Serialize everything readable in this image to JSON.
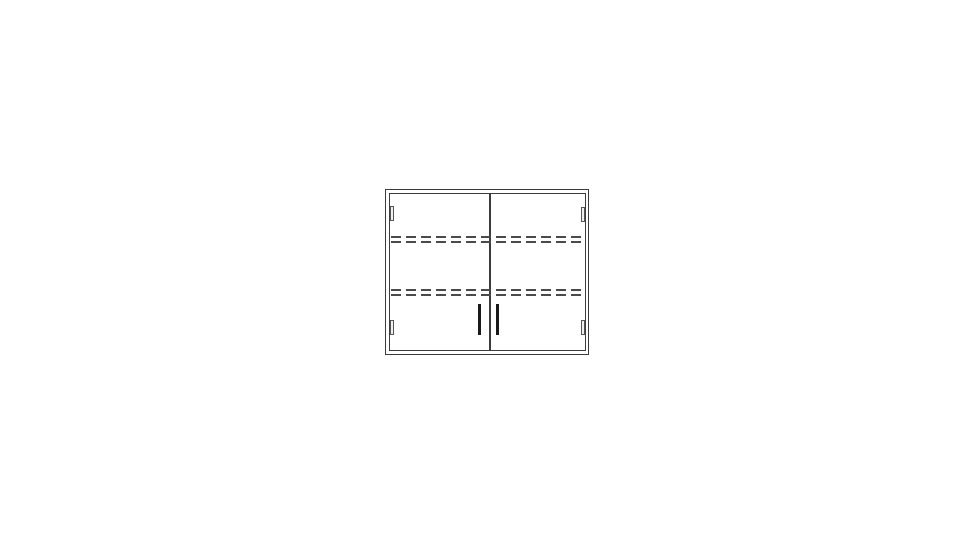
{
  "page": {
    "background_color": "#ffffff"
  },
  "drawing": {
    "title": "Double-door cabinet, front elevation line drawing",
    "type": "technical-line-drawing",
    "colors": {
      "outline": "#3c3c3c",
      "hidden_line": "#4a4a4a",
      "handle": "#1a1a1a",
      "hinge_fill": "#f0f0f0",
      "hinge_edge": "#555555",
      "background": "#ffffff"
    },
    "parts": {
      "outer_frame": "cabinet carcass outline",
      "doors": "two door leaves split by a center line",
      "shelves": "two adjustable shelves shown as double dashed hidden lines",
      "hinges": "four hinge plates: top-left, bottom-left, top-right, bottom-right",
      "handles": "two vertical pull handles beside the center split"
    }
  }
}
